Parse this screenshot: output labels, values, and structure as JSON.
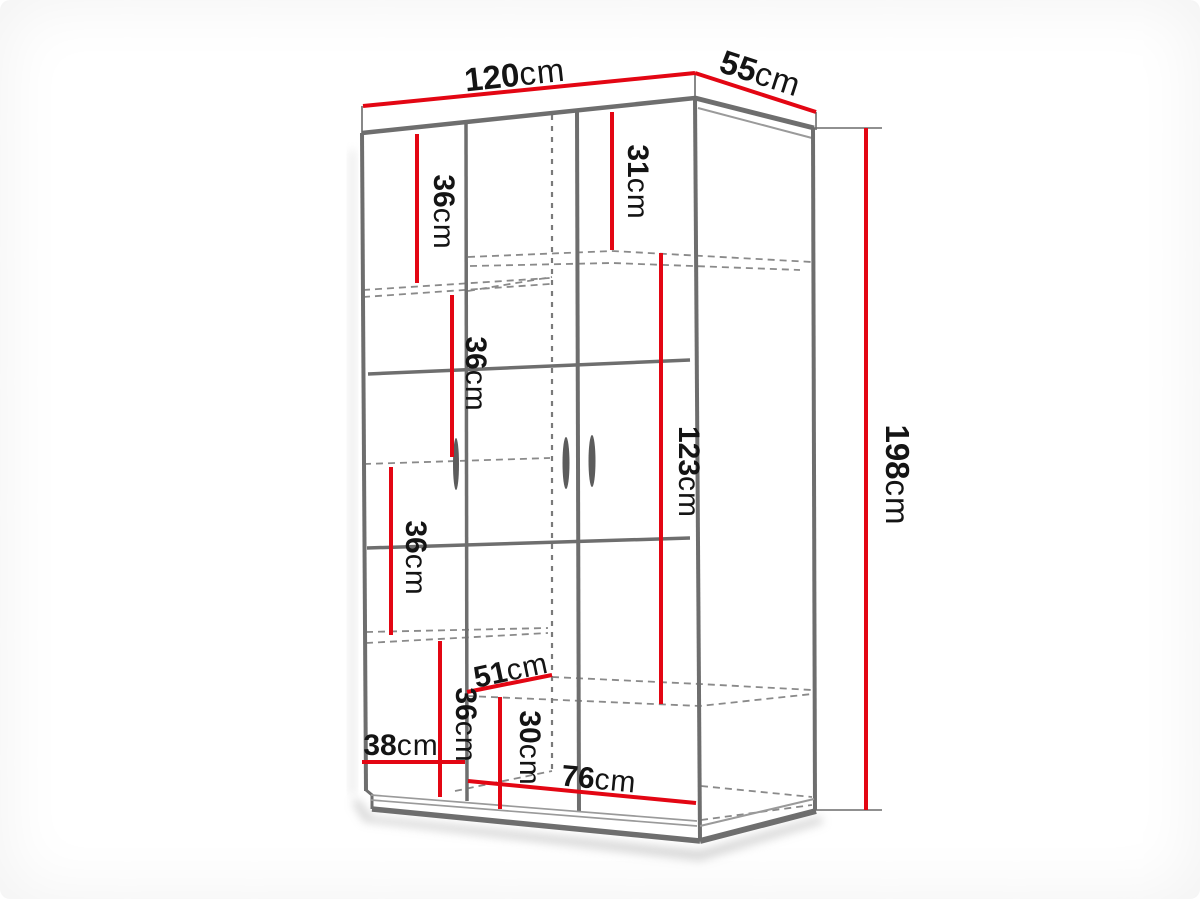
{
  "diagram": {
    "type": "furniture-dimension-diagram",
    "subject": "two-door corner wardrobe",
    "unit": "cm",
    "colors": {
      "dimension_line": "#e30613",
      "structure": "#6e6e6e",
      "dashed_hidden_line": "#8a8a8a",
      "label_text": "#141414",
      "background": "#ffffff"
    },
    "dimensions": {
      "total_width": {
        "num": "120",
        "unit": "cm"
      },
      "total_depth": {
        "num": "55",
        "unit": "cm"
      },
      "total_height": {
        "num": "198",
        "unit": "cm"
      },
      "left_top_shelf_height": {
        "num": "36",
        "unit": "cm"
      },
      "right_top_shelf_height": {
        "num": "31",
        "unit": "cm"
      },
      "left_middle_shelf_height": {
        "num": "36",
        "unit": "cm"
      },
      "left_lower_shelf_height": {
        "num": "36",
        "unit": "cm"
      },
      "left_bottom_shelf_height": {
        "num": "36",
        "unit": "cm"
      },
      "left_inner_width": {
        "num": "38",
        "unit": "cm"
      },
      "inner_depth": {
        "num": "51",
        "unit": "cm"
      },
      "bottom_compartment_height": {
        "num": "30",
        "unit": "cm"
      },
      "hanging_section_height": {
        "num": "123",
        "unit": "cm"
      },
      "right_inner_width": {
        "num": "76",
        "unit": "cm"
      }
    }
  }
}
